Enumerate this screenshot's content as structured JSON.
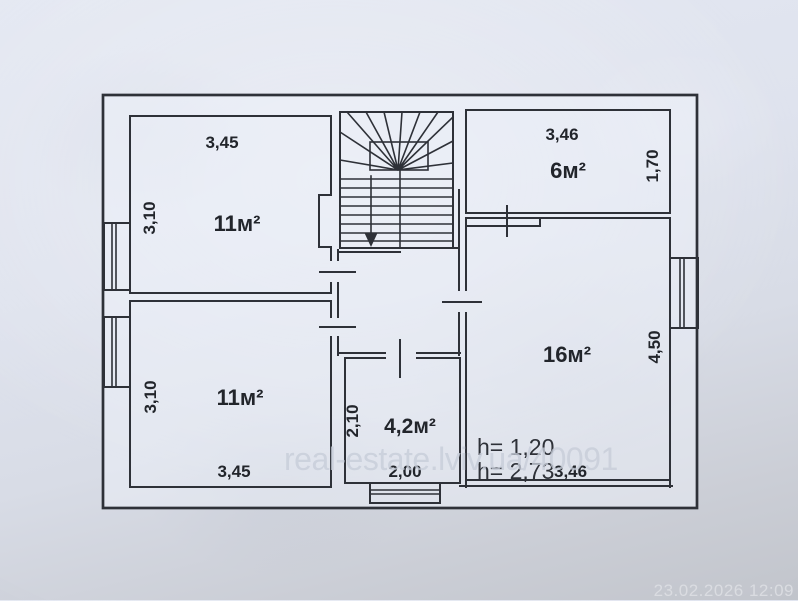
{
  "photo": {
    "watermark": "real-estate.lviv.ua/40091",
    "timestamp": "23.02.2026 12:09"
  },
  "plan": {
    "rooms": {
      "top_left": {
        "area": "11м²",
        "width": "3,45",
        "height": "3,10"
      },
      "bottom_left": {
        "area": "11м²",
        "width": "3,45",
        "height": "3,10"
      },
      "top_right": {
        "area": "6м²",
        "width": "3,46",
        "height": "1,70"
      },
      "right": {
        "area": "16м²",
        "height": "4,50",
        "width_bottom": "3,46"
      },
      "small": {
        "area": "4,2м²",
        "width": "2,00",
        "height": "2,10"
      }
    },
    "notes": {
      "ceiling_low": "h= 1,20",
      "ceiling_high": "h= 2,73"
    }
  }
}
